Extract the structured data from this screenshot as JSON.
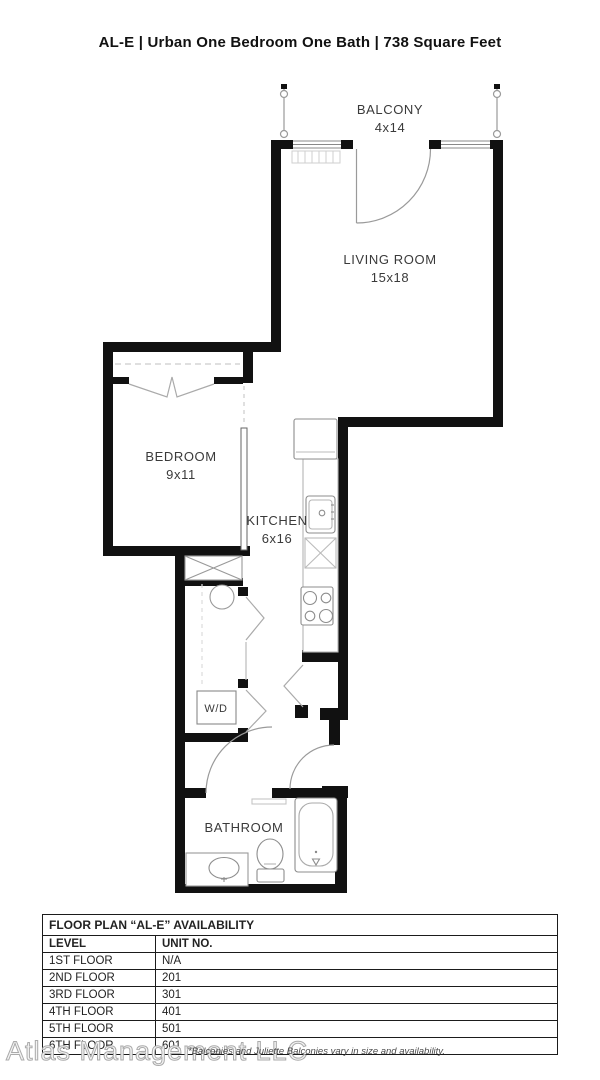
{
  "page": {
    "title": "AL-E | Urban One Bedroom One Bath | 738 Square Feet"
  },
  "plan": {
    "balcony": {
      "name": "BALCONY",
      "dims": "4x14"
    },
    "living_room": {
      "name": "LIVING ROOM",
      "dims": "15x18"
    },
    "bedroom": {
      "name": "BEDROOM",
      "dims": "9x11"
    },
    "kitchen": {
      "name": "KITCHEN",
      "dims": "6x16"
    },
    "washer_dryer": {
      "name": "W/D"
    },
    "bathroom": {
      "name": "BATHROOM"
    }
  },
  "availability_table": {
    "title": "FLOOR PLAN “AL-E” AVAILABILITY",
    "columns": [
      "LEVEL",
      "UNIT NO."
    ],
    "rows": [
      {
        "level": "1ST FLOOR",
        "unit": "N/A"
      },
      {
        "level": "2ND FLOOR",
        "unit": "201"
      },
      {
        "level": "3RD FLOOR",
        "unit": "301"
      },
      {
        "level": "4TH FLOOR",
        "unit": "401"
      },
      {
        "level": "5TH FLOOR",
        "unit": "501"
      },
      {
        "level": "6TH FLOOR",
        "unit": "601"
      }
    ]
  },
  "footer": {
    "watermark": "Atlas Management LLC",
    "disclaimer": "*Balconies and Juliette Balconies vary in size and availability."
  },
  "colors": {
    "wall": "#111111",
    "fixture_line": "#8d8d8d",
    "text": "#3a3a3a"
  }
}
